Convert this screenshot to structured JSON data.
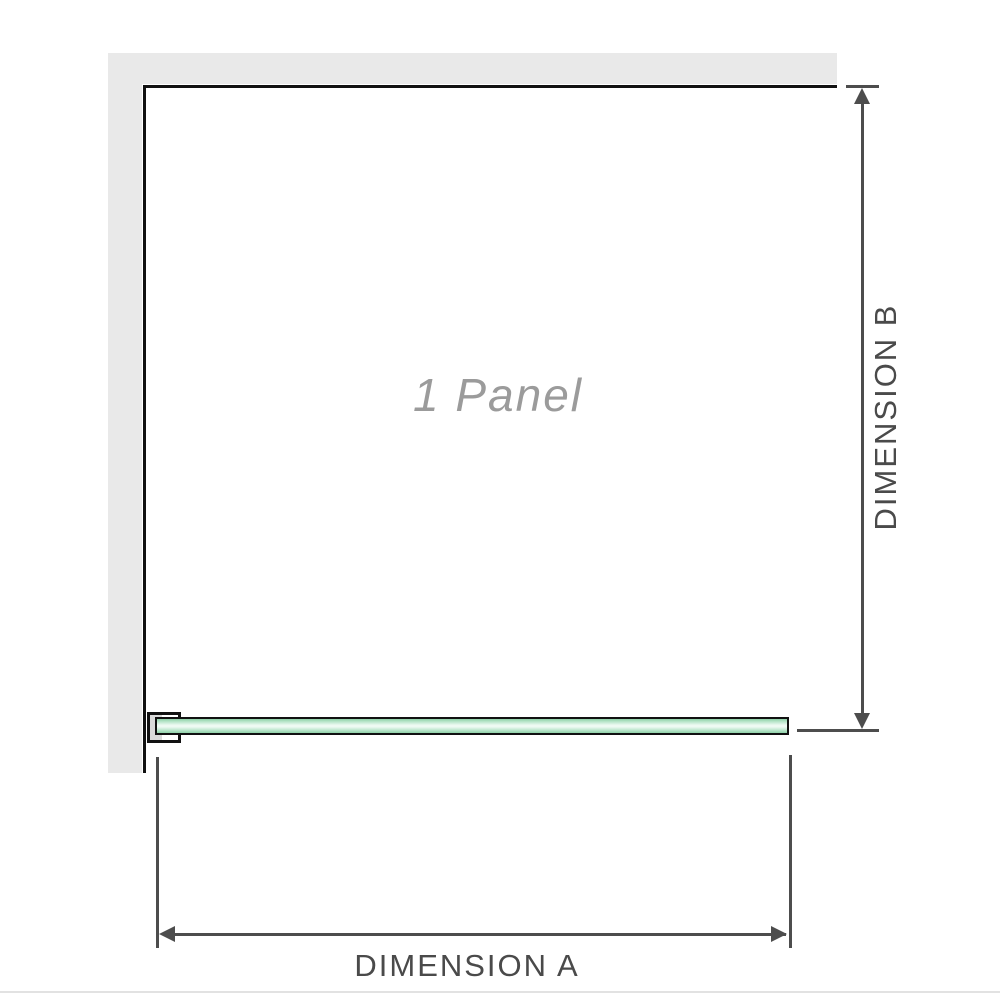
{
  "diagram": {
    "title": "Shower panel dimension diagram",
    "panel_label": "1 Panel",
    "dimension_a": {
      "label": "DIMENSION A",
      "orientation": "horizontal",
      "measures": "glass panel width"
    },
    "dimension_b": {
      "label": "DIMENSION B",
      "orientation": "vertical",
      "measures": "enclosure depth"
    },
    "panels_count": 1,
    "colors": {
      "wall_fill": "#e9e9e9",
      "outline": "#111111",
      "dimension_lines": "#4d4d4d",
      "dimension_text": "#4a4a4a",
      "glass_green": "#8fd1a8",
      "glass_highlight": "#eefaf3",
      "bracket_pad": "#d9d9d9",
      "panel_label_text": "#9b9b9b",
      "baseline": "#e2e2e2"
    }
  }
}
